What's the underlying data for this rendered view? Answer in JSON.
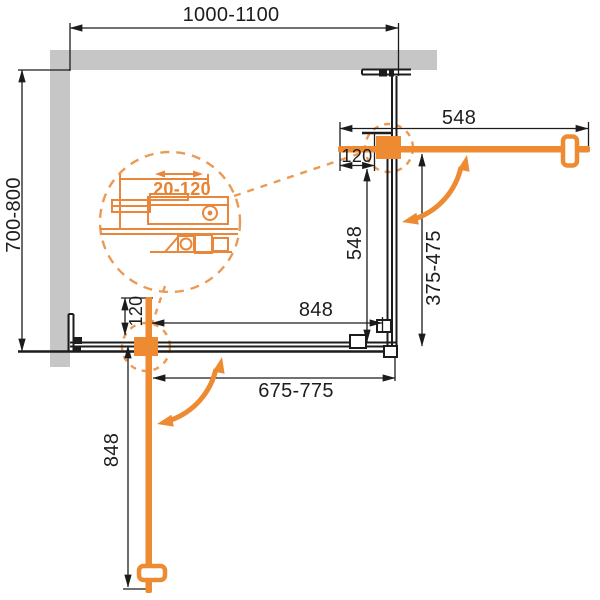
{
  "drawing": {
    "title": "shower-enclosure-corner-entry-technical-plan",
    "colors": {
      "accent_orange": "#EE8A31",
      "detail_orange": "#E8873B",
      "dashed_orange": "#EB9A55",
      "wall_gray": "#C6C6C6",
      "line_black": "#1C1C1C"
    },
    "labels": {
      "overall_width": "1000-1100",
      "overall_depth": "700-800",
      "door_right_open": "548",
      "door_right_closed": "548",
      "top_offset": "120",
      "side_panel_right": "375-475",
      "bottom_panel": "848",
      "bottom_offset": "120",
      "bottom_opening": "675-775",
      "door_bottom_open": "848",
      "detail_adjustment": "20-120"
    }
  }
}
